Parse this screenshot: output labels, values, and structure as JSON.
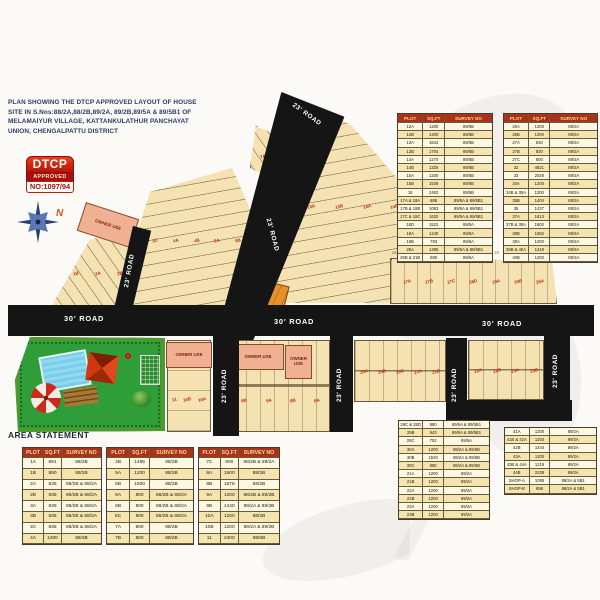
{
  "title": {
    "l1": "PLAN SHOWING THE DTCP APPROVED LAYOUT OF HOUSE",
    "l2": "SITE IN S.Nos:88/2A,88/2B,89/2A, 89/2B,89/5A & 89/5B1 OF",
    "l3": "MELAMAIYUR VILLAGE, KATTANKULATHUR PANCHAYAT",
    "l4": "UNION, CHENGALPATTU DISTRICT"
  },
  "badge": {
    "line1": "DTCP",
    "line2": "APPROVED",
    "number": "NO:1097/94"
  },
  "compass": {
    "north": "N"
  },
  "area_statement_label": "AREA STATEMENT",
  "table_headers": [
    "PLOT",
    "SQ.FT",
    "SURVEY NO"
  ],
  "map": {
    "road23": "23' ROAD",
    "road30": "30' ROAD",
    "owner_use": "OWNER USE",
    "plot_labels": {
      "block_west": [
        "1A",
        "1B",
        "2A",
        "2B"
      ],
      "fan_left": [
        "3A",
        "3B",
        "3C",
        "4A",
        "4B",
        "5A",
        "5B",
        "6A"
      ],
      "block_top_small": [
        "7A",
        "7B"
      ],
      "triangle_right": [
        "12A",
        "12B",
        "13A",
        "13B",
        "14A",
        "14B",
        "15A",
        "15B",
        "16"
      ],
      "strip_right": [
        "17A",
        "17B",
        "17C",
        "18D",
        "19A",
        "19B",
        "25A"
      ],
      "block_s1": [
        "11",
        "10B",
        "10A"
      ],
      "block_s2": [
        "9B",
        "9A",
        "8B",
        "8A"
      ],
      "block_s3": [
        "20A",
        "20B",
        "20C",
        "21A",
        "21B"
      ],
      "block_s4": [
        "22A",
        "22B",
        "23A",
        "23B"
      ]
    },
    "dims_top": [
      "23'",
      "23'",
      "23'",
      "24'",
      "23'",
      "23'",
      "23'6\""
    ]
  },
  "tables": {
    "top_right_1": [
      [
        "12A",
        "1200",
        "89/5B"
      ],
      [
        "12B",
        "1200",
        "89/5B"
      ],
      [
        "13A",
        "1644",
        "89/5B"
      ],
      [
        "13B",
        "1704",
        "89/5B"
      ],
      [
        "14A",
        "1270",
        "89/5B"
      ],
      [
        "14B",
        "1325",
        "89/5B"
      ],
      [
        "15A",
        "1200",
        "89/5B"
      ],
      [
        "15B",
        "1536",
        "89/5B"
      ],
      [
        "16",
        "2483",
        "89/5B"
      ],
      [
        "17A & 18A",
        "885",
        "89/5A & 89/5B1"
      ],
      [
        "17B & 18B",
        "1083",
        "89/5A & 89/5B1"
      ],
      [
        "17C & 18C",
        "1620",
        "89/5A & 89/5B1"
      ],
      [
        "18D",
        "1522",
        "89/5A"
      ],
      [
        "19A",
        "1240",
        "89/5A"
      ],
      [
        "19B",
        "783",
        "89/5A"
      ],
      [
        "25A",
        "1385",
        "89/5A & 89/5B1"
      ],
      [
        "25B & 21B",
        "880",
        "89/5A"
      ]
    ],
    "top_right_2": [
      [
        "26A",
        "1200",
        "89/2A"
      ],
      [
        "26B",
        "1200",
        "89/2A"
      ],
      [
        "27A",
        "830",
        "89/2A"
      ],
      [
        "27B",
        "830",
        "89/2A"
      ],
      [
        "27C",
        "800",
        "89/2A"
      ],
      [
        "32",
        "4821",
        "89/2A"
      ],
      [
        "33",
        "2028",
        "89/2A"
      ],
      [
        "34A",
        "1200",
        "89/2A"
      ],
      [
        "34B & 35A",
        "1200",
        "89/2A"
      ],
      [
        "35B",
        "1404",
        "89/2A"
      ],
      [
        "36",
        "1437",
        "89/2A"
      ],
      [
        "37A",
        "1813",
        "89/2A"
      ],
      [
        "37B & 38A",
        "1600",
        "89/2A"
      ],
      [
        "38B",
        "1582",
        "89/2A"
      ],
      [
        "39A",
        "1200",
        "89/2A"
      ],
      [
        "39B & 40A",
        "1219",
        "89/2A"
      ],
      [
        "40B",
        "1200",
        "89/2A"
      ]
    ],
    "bottom_1": [
      [
        "1A",
        "891",
        "88/2B"
      ],
      [
        "1B",
        "890",
        "88/2B"
      ],
      [
        "2A",
        "838",
        "88/2B & 88/2A"
      ],
      [
        "2B",
        "838",
        "88/2B & 88/2A"
      ],
      [
        "3A",
        "838",
        "88/2B & 88/2A"
      ],
      [
        "3B",
        "838",
        "88/2B & 88/2A"
      ],
      [
        "3C",
        "838",
        "88/2B & 88/2A"
      ],
      [
        "4A",
        "1200",
        "88/2B"
      ]
    ],
    "bottom_2": [
      [
        "4B",
        "1485",
        "88/2B"
      ],
      [
        "5A",
        "1200",
        "88/2B"
      ],
      [
        "5B",
        "1500",
        "88/2B"
      ],
      [
        "6A",
        "800",
        "88/2B & 88/2A"
      ],
      [
        "6B",
        "800",
        "88/2B & 88/2A"
      ],
      [
        "6C",
        "800",
        "88/2B & 88/2A"
      ],
      [
        "7A",
        "800",
        "88/2B"
      ],
      [
        "7B",
        "800",
        "88/2B"
      ]
    ],
    "bottom_3": [
      [
        "7C",
        "800",
        "88/2B & 88/2A"
      ],
      [
        "8A",
        "1500",
        "88/2B"
      ],
      [
        "8B",
        "1678",
        "88/2B"
      ],
      [
        "9A",
        "1200",
        "88/2B & 89/2B"
      ],
      [
        "9B",
        "1440",
        "89/2A & 89/2B"
      ],
      [
        "10A",
        "1200",
        "88/2B"
      ],
      [
        "10B",
        "1200",
        "89/2A & 89/2B"
      ],
      [
        "11",
        "2400",
        "89/5B"
      ]
    ],
    "bottom_right_1": [
      [
        "28C & 28D",
        "880",
        "89/5A & 89/5B1"
      ],
      [
        "29B",
        "943",
        "89/5A & 89/5B1"
      ],
      [
        "29C",
        "752",
        "89/5A"
      ],
      [
        "30A",
        "1200",
        "89/2A & 89/5B"
      ],
      [
        "30B",
        "1520",
        "89/2A & 89/5B"
      ],
      [
        "30C",
        "880",
        "89/2A & 89/5B"
      ],
      [
        "21A",
        "1200",
        "89/2A"
      ],
      [
        "21B",
        "1200",
        "89/2A"
      ],
      [
        "22A",
        "1200",
        "89/2A"
      ],
      [
        "22B",
        "1200",
        "89/2A"
      ],
      [
        "23A",
        "1200",
        "89/2A"
      ],
      [
        "23B",
        "1200",
        "89/2A"
      ]
    ],
    "bottom_right_2": [
      [
        "41A",
        "1200",
        "89/2A"
      ],
      [
        "41B & 42A",
        "1204",
        "89/2A"
      ],
      [
        "42B",
        "1444",
        "89/2A"
      ],
      [
        "43A",
        "1200",
        "89/2A"
      ],
      [
        "43B & 44A",
        "1219",
        "89/2A"
      ],
      [
        "44B",
        "2238",
        "89/2A"
      ],
      [
        "SHOP-A",
        "1085",
        "89/2A & 5B1"
      ],
      [
        "SHOP-B",
        "898",
        "89/2A & 5B1"
      ]
    ]
  },
  "colors": {
    "road_black": "#151515",
    "plot_tan": "#f4e2b2",
    "owner_use_pink": "#f0b193",
    "shop_orange": "#e8912c",
    "park_green": "#2f9e38",
    "table_header_red": "#a8321c",
    "badge_red": "#c21a0c",
    "plot_number_red": "#c0290e",
    "title_navy": "#2a3a63"
  }
}
